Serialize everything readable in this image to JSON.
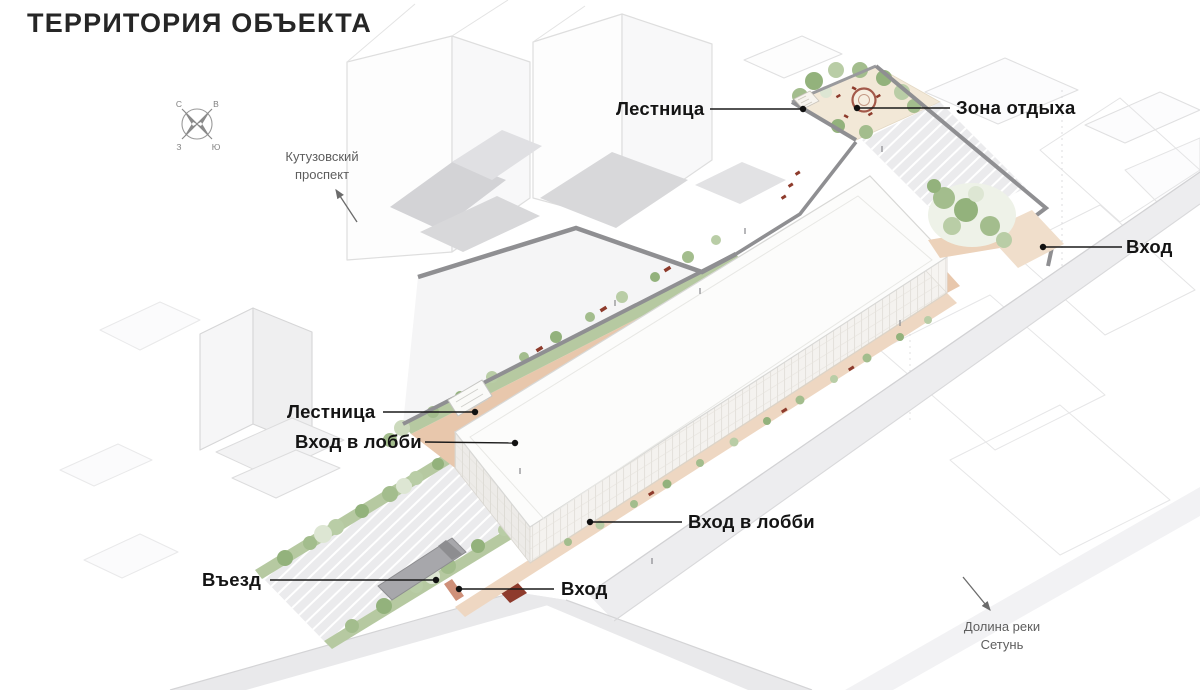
{
  "title": "ТЕРРИТОРИЯ ОБЪЕКТА",
  "compass": {
    "north": "С",
    "east": "В",
    "west": "З",
    "south": "Ю"
  },
  "annotations": [
    {
      "id": "stairs-top",
      "label": "Лестница"
    },
    {
      "id": "recreation-zone",
      "label": "Зона отдыха"
    },
    {
      "id": "entrance-right",
      "label": "Вход"
    },
    {
      "id": "stairs-left",
      "label": "Лестница"
    },
    {
      "id": "lobby-entrance-left",
      "label": "Вход в лобби"
    },
    {
      "id": "lobby-entrance-bottom",
      "label": "Вход в лобби"
    },
    {
      "id": "driveway",
      "label": "Въезд"
    },
    {
      "id": "entrance-bottom",
      "label": "Вход"
    }
  ],
  "direction_labels": [
    {
      "id": "kutuzovsky-prospekt",
      "label": "Кутузовский проспект"
    },
    {
      "id": "setun-river-valley",
      "label": "Долина реки Сетунь"
    }
  ],
  "colors": {
    "label_text": "#141414",
    "muted_text": "#5e5e5e",
    "path_pink": "#e8c7ac",
    "greenery": "#a3bd8d",
    "accent_red": "#8e3b2c",
    "wall_gray": "#8f8f92"
  }
}
